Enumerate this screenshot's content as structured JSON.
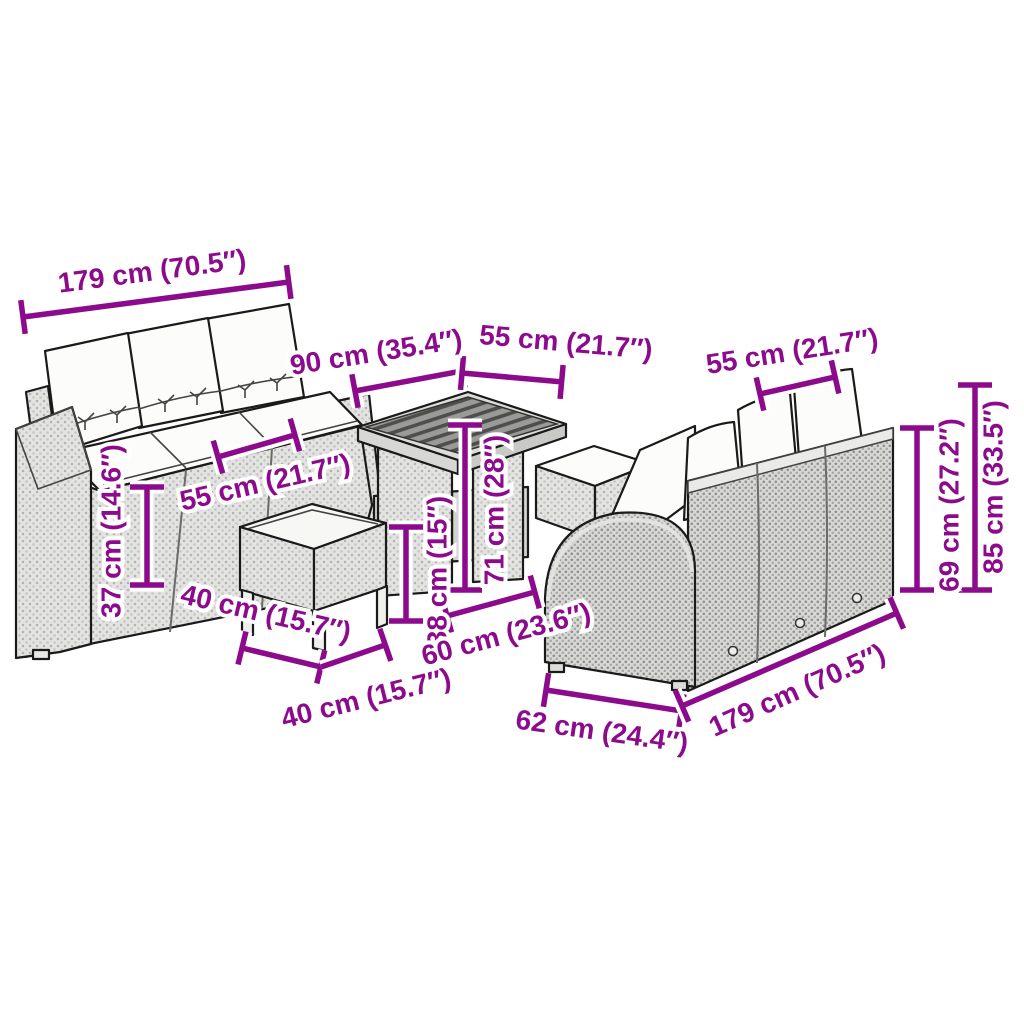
{
  "illustration": {
    "background": "#ffffff",
    "accent_color": "#8C0B8C",
    "items": [
      "three-seater garden sofa with cushions (front view)",
      "square poly rattan dining table",
      "footstool with cushion (front)",
      "footstool with cushion (behind table)",
      "three-seater garden sofa with cushions (rear view)"
    ]
  },
  "measurements": [
    {
      "name": "left-sofa-width",
      "label": "179 cm (70.5″)"
    },
    {
      "name": "table-length",
      "label": "90 cm (35.4″)"
    },
    {
      "name": "table-width",
      "label": "55 cm (21.7″)"
    },
    {
      "name": "right-sofa-seat-width",
      "label": "55 cm (21.7″)"
    },
    {
      "name": "left-sofa-seat-width",
      "label": "55 cm (21.7″)"
    },
    {
      "name": "seat-height",
      "label": "37 cm (14.6″)"
    },
    {
      "name": "table-height",
      "label": "71 cm (28″)"
    },
    {
      "name": "stool-height",
      "label": "38 cm (15″)"
    },
    {
      "name": "stool-depth",
      "label": "40 cm (15.7″)"
    },
    {
      "name": "stool-width",
      "label": "40 cm (15.7″)"
    },
    {
      "name": "sofa-section-depth",
      "label": "60 cm (23.6″)"
    },
    {
      "name": "right-sofa-depth",
      "label": "62 cm (24.4″)"
    },
    {
      "name": "right-sofa-width",
      "label": "179 cm (70.5″)"
    },
    {
      "name": "backrest-height",
      "label": "69 cm (27.2″)"
    },
    {
      "name": "total-height",
      "label": "85 cm (33.5″)"
    }
  ]
}
